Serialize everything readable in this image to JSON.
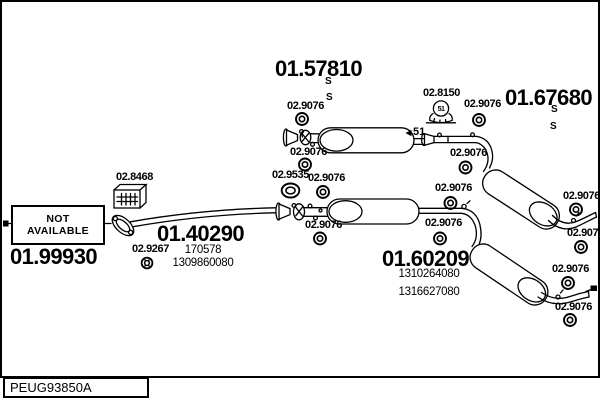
{
  "drawing": {
    "code": "PEUG93850A"
  },
  "assemblies": {
    "silencer_middle_top": {
      "part_number": "01.57810",
      "marks": [
        "S",
        "S"
      ]
    },
    "silencer_rear_top": {
      "part_number": "01.67680",
      "marks": [
        "S",
        "S"
      ]
    },
    "front_pipe": {
      "part_number": "01.40290",
      "oe_refs": [
        "170578",
        "1309860080"
      ]
    },
    "silencer_rear_bottom": {
      "part_number": "01.60209",
      "oe_refs": [
        "1310264080",
        "1316627080"
      ]
    },
    "unavailable": {
      "part_number": "01.99930",
      "status_line1": "NOT",
      "status_line2": "AVAILABLE"
    }
  },
  "fittings": {
    "ring_gasket": "02.9076",
    "clamp": "02.8150",
    "clamp_size": "51",
    "seal_ring_large": "02.9535",
    "heat_shield": "02.8468",
    "ring_small": "02.9267"
  }
}
